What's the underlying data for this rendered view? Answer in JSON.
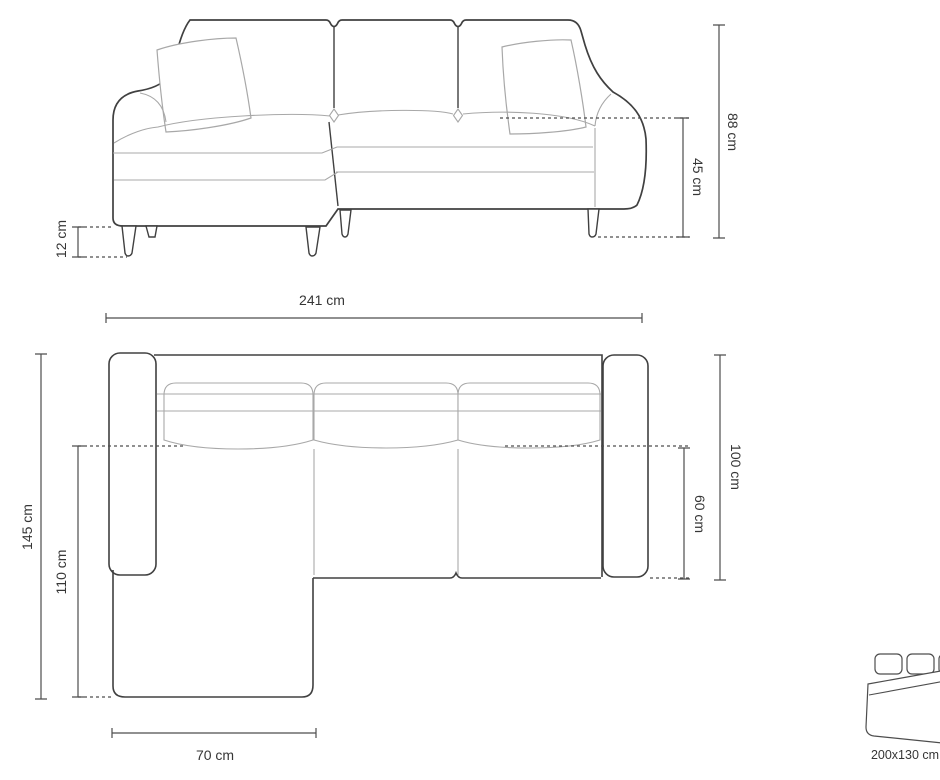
{
  "front_view": {
    "total_width": "241 cm",
    "total_height": "88 cm",
    "seat_height": "45 cm",
    "leg_height": "12 cm"
  },
  "top_view": {
    "total_depth": "145 cm",
    "chaise_depth": "110 cm",
    "frame_depth": "100 cm",
    "seat_depth": "60 cm",
    "chaise_width": "70 cm"
  },
  "sleeping_area": {
    "label": "200x130 cm",
    "icon": "sofa-bed-icon"
  },
  "colors": {
    "background": "#ffffff",
    "outline-dark": "#404040",
    "outline-light": "#a8a8a8",
    "dimension": "#4d4d4d",
    "text": "#363636"
  }
}
